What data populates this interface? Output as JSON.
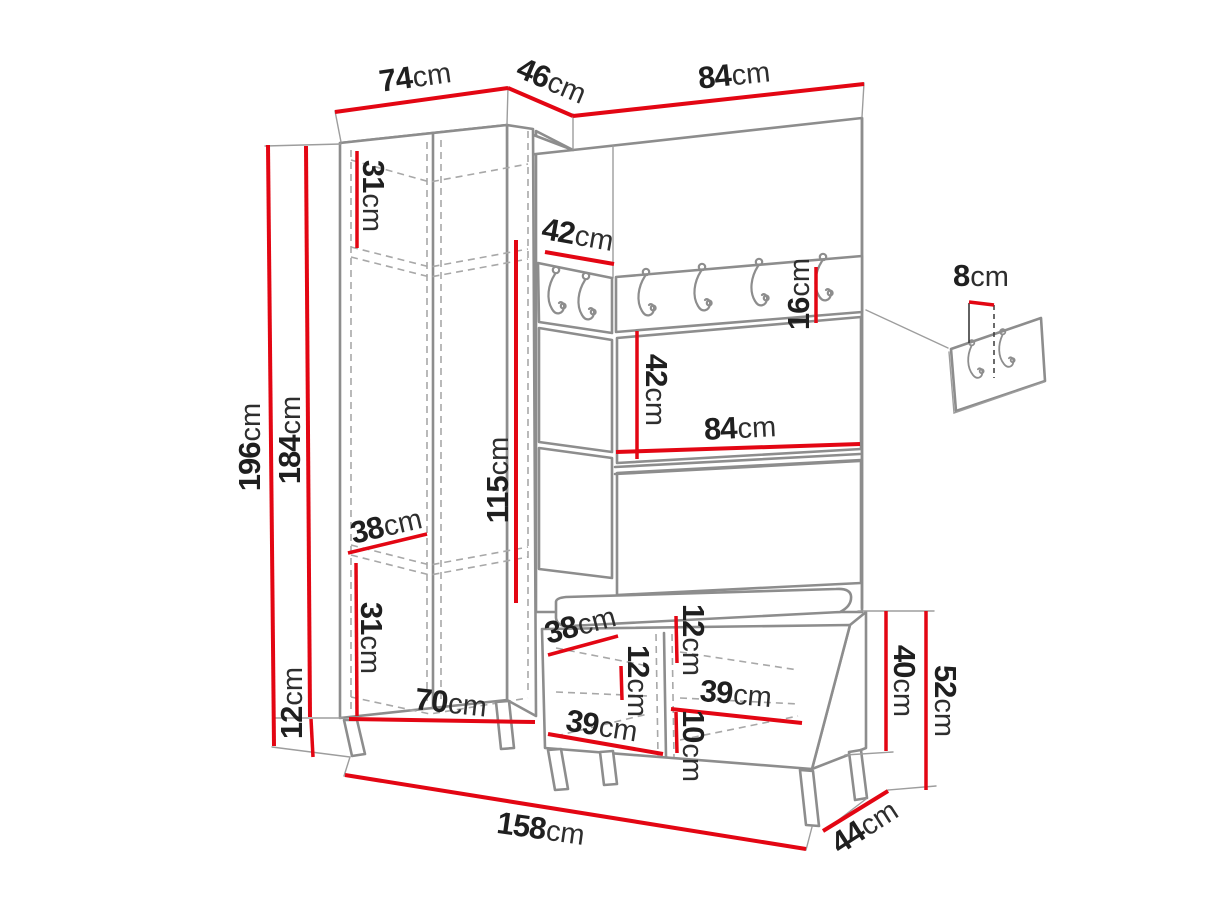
{
  "diagram": {
    "type": "furniture-technical-drawing",
    "subject": "hallway wardrobe set with coat hook rail, wall hook panel and shoe bench",
    "unit": "cm"
  },
  "colors": {
    "dimension_line": "#e30613",
    "outline": "#8d8d8d",
    "hidden_line": "#a8a8a8",
    "label_text": "#1f1f1f",
    "background": "#ffffff"
  },
  "hook_counts": {
    "rail_left_section": 2,
    "rail_main_section": 4,
    "detail_panel": 2
  },
  "dimensions": {
    "d74": {
      "value": "74",
      "unit": "cm"
    },
    "d46": {
      "value": "46",
      "unit": "cm"
    },
    "d84_top": {
      "value": "84",
      "unit": "cm"
    },
    "d196": {
      "value": "196",
      "unit": "cm"
    },
    "d184": {
      "value": "184",
      "unit": "cm"
    },
    "d12_legs": {
      "value": "12",
      "unit": "cm"
    },
    "d31_top": {
      "value": "31",
      "unit": "cm"
    },
    "d115": {
      "value": "115",
      "unit": "cm"
    },
    "d42_hooks": {
      "value": "42",
      "unit": "cm"
    },
    "d16": {
      "value": "16",
      "unit": "cm"
    },
    "d42_mid": {
      "value": "42",
      "unit": "cm"
    },
    "d84_mid": {
      "value": "84",
      "unit": "cm"
    },
    "d38_wardrobe": {
      "value": "38",
      "unit": "cm"
    },
    "d31_bottom": {
      "value": "31",
      "unit": "cm"
    },
    "d70": {
      "value": "70",
      "unit": "cm"
    },
    "d38_bench": {
      "value": "38",
      "unit": "cm"
    },
    "d12_bench_left": {
      "value": "12",
      "unit": "cm"
    },
    "d12_bench_top": {
      "value": "12",
      "unit": "cm"
    },
    "d10_bench": {
      "value": "10",
      "unit": "cm"
    },
    "d39_bench_left": {
      "value": "39",
      "unit": "cm"
    },
    "d39_bench_right": {
      "value": "39",
      "unit": "cm"
    },
    "d158": {
      "value": "158",
      "unit": "cm"
    },
    "d44": {
      "value": "44",
      "unit": "cm"
    },
    "d40": {
      "value": "40",
      "unit": "cm"
    },
    "d52": {
      "value": "52",
      "unit": "cm"
    },
    "d8_detail": {
      "value": "8",
      "unit": "cm"
    }
  }
}
